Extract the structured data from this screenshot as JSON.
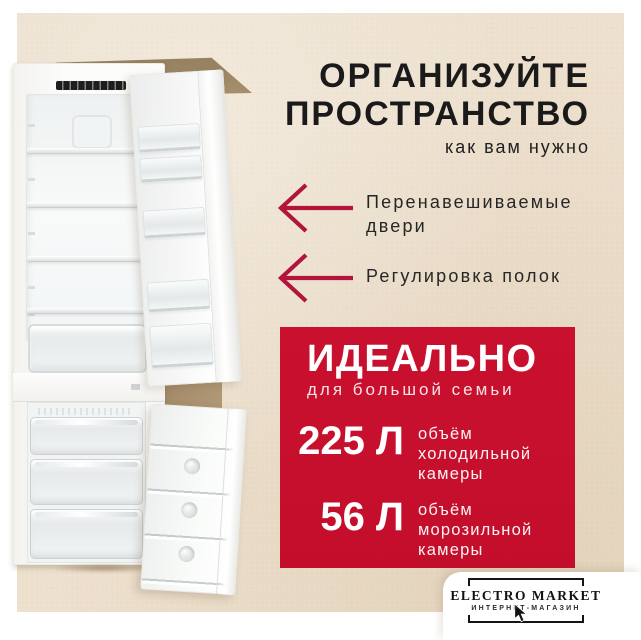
{
  "colors": {
    "background_beige": "#ecdfcc",
    "frame_white": "#ffffff",
    "panel_red": "#c60f2d",
    "arrow_red": "#b2143c",
    "text_dark": "#1a1a1a",
    "cabinet_brown": "#a8906b"
  },
  "headline": {
    "line1": "ОРГАНИЗУЙТЕ",
    "line2": "ПРОСТРАНСТВО",
    "subtitle": "как вам нужно"
  },
  "features": [
    {
      "label": "Перенавешиваемые двери"
    },
    {
      "label": "Регулировка полок"
    }
  ],
  "highlight": {
    "title": "ИДЕАЛЬНО",
    "subtitle": "для большой семьи",
    "specs": [
      {
        "value": "225 Л",
        "description": "объём холодильной камеры"
      },
      {
        "value": "56 Л",
        "description": "объём морозильной камеры"
      }
    ]
  },
  "logo": {
    "name": "ELECTRO MARKET",
    "tagline": "ИНТЕРНЕТ-МАГАЗИН"
  }
}
